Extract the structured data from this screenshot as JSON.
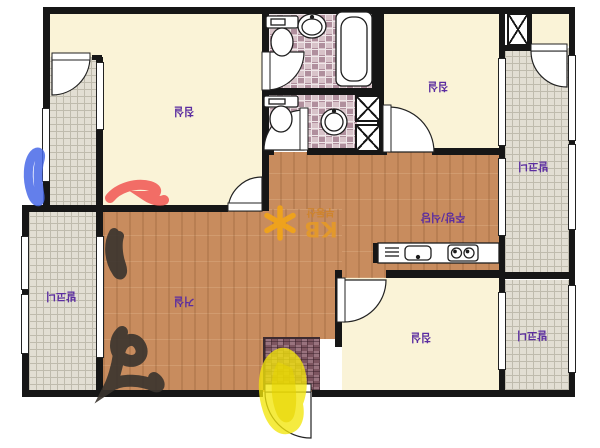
{
  "plan": {
    "rooms": {
      "bedroom_top_left": {
        "label": "침실"
      },
      "bedroom_top_right": {
        "label": "침실"
      },
      "bedroom_bottom": {
        "label": "침실"
      },
      "living_room": {
        "label": "거실"
      },
      "kitchen_dining": {
        "label": "주방/식당"
      },
      "balcony_left": {
        "label": "발코니"
      },
      "balcony_right_upper": {
        "label": "발코니"
      },
      "balcony_right_lower": {
        "label": "발코니"
      }
    },
    "watermark": {
      "brand": "KB",
      "subtitle": "부동산",
      "icon": "kb-star-icon",
      "color": "#EDA02A"
    },
    "label_color": "#5B2DA0",
    "label_rotation_deg": 180,
    "colors": {
      "room_cream": "#FAF3D7",
      "wood_floor": "#C88C5E",
      "bathroom_tile": "#BC9DA9",
      "balcony_tile": "#E2DED3",
      "entrance_tile": "#8A5F6B",
      "wall": "#161616"
    },
    "marker_annotations": {
      "blue": "#4868E8",
      "red": "#F05552",
      "black": "#38332E",
      "yellow": "#F2E60A"
    },
    "fixtures": [
      "toilet",
      "toilet",
      "oval-sink",
      "round-sink",
      "bathtub",
      "kitchen-counter",
      "kitchen-sink",
      "stove-2-burner",
      "vent-grille",
      "duct-shaft",
      "duct-shaft",
      "duct-shaft"
    ]
  }
}
